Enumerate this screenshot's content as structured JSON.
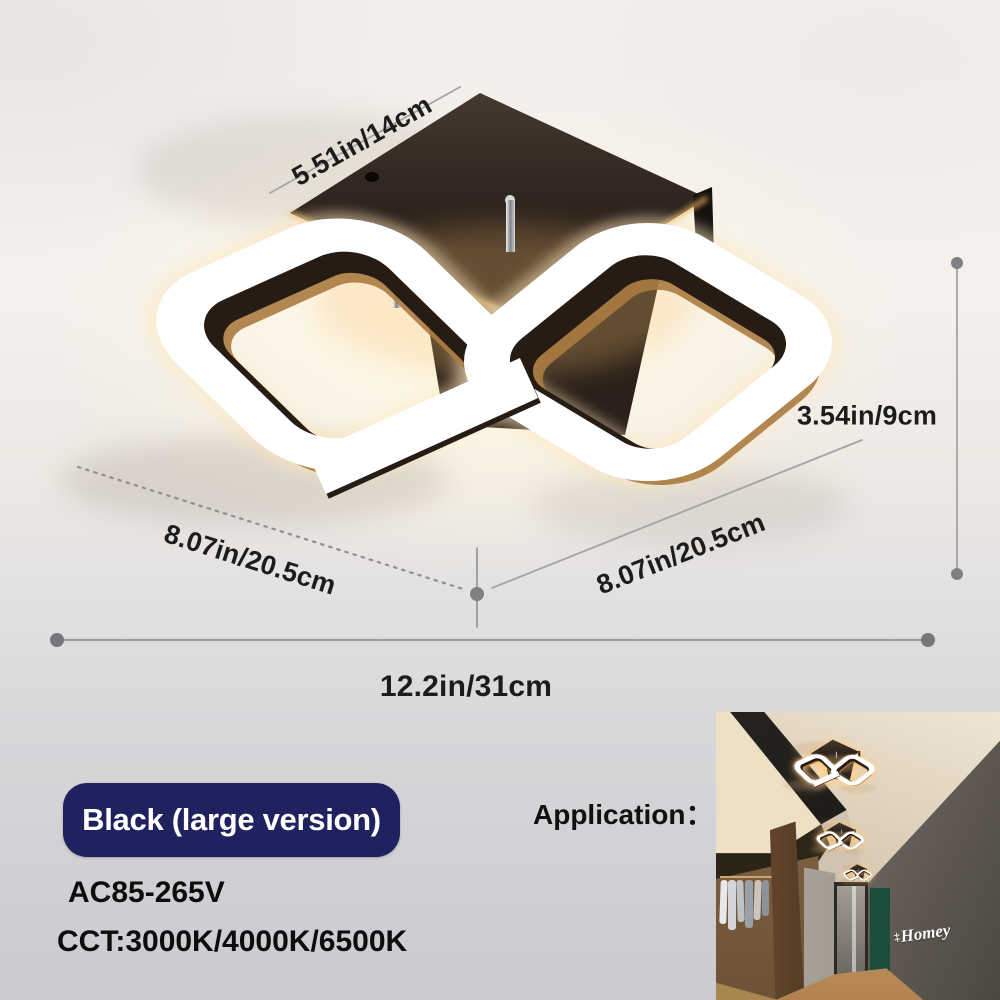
{
  "image_type": "product-dimension-photo",
  "product": {
    "name": "led-square-ceiling-lamp",
    "dimensions": {
      "canopy_width": "5.51in/14cm",
      "fixture_height": "3.54in/9cm",
      "left_ring_width": "8.07in/20.5cm",
      "right_ring_width": "8.07in/20.5cm",
      "total_width": "12.2in/31cm"
    },
    "variant_badge": "Black (large version)",
    "voltage": "AC85-265V",
    "color_temperature": "CCT:3000K/4000K/6500K"
  },
  "application": {
    "label": "Application：",
    "wall_sign_ornament": "‡",
    "wall_sign_text": "Homey"
  },
  "colors": {
    "badge_background": "#20225f",
    "badge_text": "#ffffff",
    "dimension_text": "#1c1c1c",
    "dimension_lines": "#97979b",
    "spec_text": "#0d0d0d",
    "accent_green_wall": "#1a4e3a",
    "warm_glow": "#ffd9a0"
  }
}
